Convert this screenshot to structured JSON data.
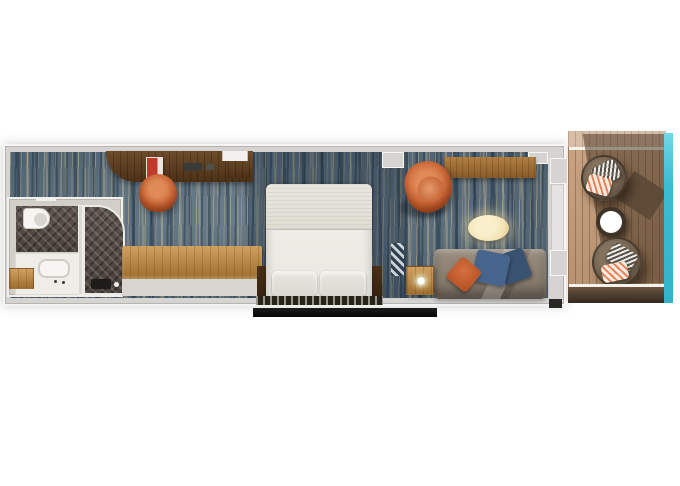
{
  "image_type": "cruise-stateroom-floorplan-render",
  "visible_text": [],
  "colors": {
    "wall": "#d6d4d1",
    "wall_edge": "#f6f5f3",
    "carpet_base": "#5a7082",
    "carpet_gold": "#cfb47c",
    "carpet_shadow": "#203040",
    "bath_wall": "#d2cfc9",
    "bath_floor": "#57504a",
    "fixture_white": "#f6f5f1",
    "wood_dark": "#5e3f22",
    "wood_medium": "#a06f38",
    "wood_light": "#c2945c",
    "deck_wood": "#c49c78",
    "deck_shadow": "#3a2d22",
    "bed_linen": "#efede7",
    "headboard": "#282219",
    "accent_orange": "#c75f2e",
    "pillow_blue": "#47658c",
    "sofa_taupe": "#8b7f71",
    "table_cream": "#f3e2b3",
    "glass_teal": "#45c4d8",
    "wicker": "#6f5f4d",
    "entry_floor": "#d8d5d0",
    "black_trim": "#111111"
  },
  "rooms": {
    "bathroom": {
      "features": [
        "toilet",
        "vanity-sink",
        "shower-stall",
        "towel-shelf",
        "herringbone-floor"
      ]
    },
    "entry": {
      "features": [
        "writing-desk",
        "desk-chair",
        "dresser-bench"
      ]
    },
    "bedroom": {
      "features": [
        "double-bed",
        "two-pillows",
        "headboard",
        "side-panels",
        "wardrobe",
        "chevron-pouf"
      ]
    },
    "lounge": {
      "features": [
        "orange-armchair",
        "oval-ottoman",
        "sofa",
        "throw-pillows",
        "side-table-with-lamp",
        "wall-shelf"
      ]
    },
    "balcony": {
      "features": [
        "wicker-chair-top",
        "wicker-chair-bottom",
        "round-table",
        "wood-deck",
        "glass-railing"
      ]
    }
  }
}
